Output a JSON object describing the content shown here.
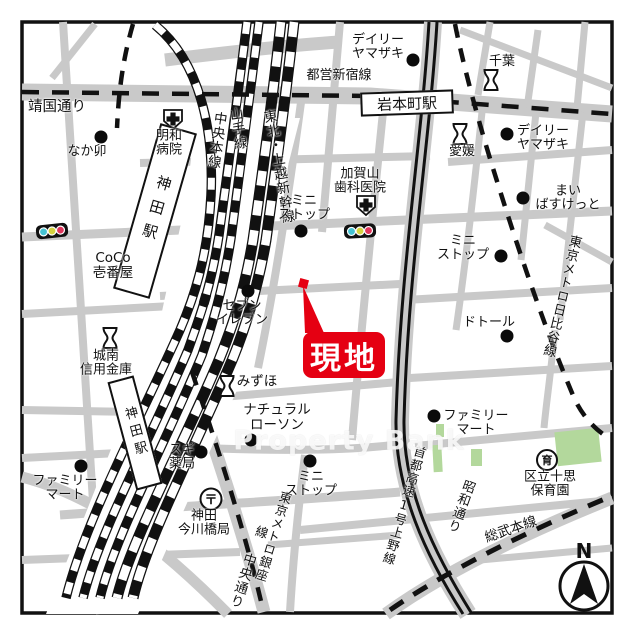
{
  "map": {
    "watermark": "Property Bank",
    "compass_n": "N",
    "site": {
      "label": "現地"
    },
    "roads": {
      "yasukuni_dori": "靖国通り",
      "chuo_dori": "中央通り",
      "showa_dori": "昭和通り",
      "shuto_expressway": "首都高速1号上野線"
    },
    "railways": {
      "toei_shinjuku_line": "都営新宿線",
      "chuo_main_line": "中央本線",
      "yamanote_line": "山手線",
      "tohoku_joetsu_shinkansen": "東北・上越新幹線",
      "tokyo_metro_hibiya_line": "東京メトロ日比谷線",
      "tokyo_metro_ginza_line": "東京メトロ銀座線",
      "sobu_main_line": "総武本線"
    },
    "stations": {
      "iwamotocho": "岩本町駅",
      "kanda_building": "神田駅",
      "kanda_track": "神田駅"
    },
    "pois": {
      "daily_yamazaki_north": "デイリー\nヤマザキ",
      "chiba_bank": "千葉",
      "ehime_bank": "愛媛",
      "daily_yamazaki_east": "デイリー\nヤマザキ",
      "nakau": "なか卯",
      "meiwa_hospital": "明和\n病院",
      "kagayama_dental": "加賀山\n歯科医院",
      "ministop_center": "ミニ\nストップ",
      "ministop_east": "ミニ\nストップ",
      "ministop_south": "ミニ\nストップ",
      "maibasket": "まい\nばすけっと",
      "coco_ichibanya": "CoCo\n壱番屋",
      "seven_eleven": "セブン\nイレブン",
      "doutor": "ドトール",
      "jonan_shinkin": "城南\n信用金庫",
      "mizuho": "みずほ",
      "natural_lawson": "ナチュラル\nローソン",
      "familymart_east": "ファミリー\nマート",
      "familymart_southwest": "ファミリー\nマート",
      "sugi_pharmacy": "スギ\n薬局",
      "kanda_imagawabashi_post": "神田\n今川橋局",
      "jisshi_nursery": "区立十思\n保育園"
    },
    "icons": {
      "post_office_glyph": "〒",
      "nursery_glyph": "育"
    },
    "colors": {
      "site_red": "#e50012",
      "road_gray": "#c9c9c9",
      "park_green": "#b3d89c",
      "signal_cyan": "#45c3d2",
      "signal_yellow": "#d5d33f",
      "signal_red": "#e0365c"
    }
  }
}
